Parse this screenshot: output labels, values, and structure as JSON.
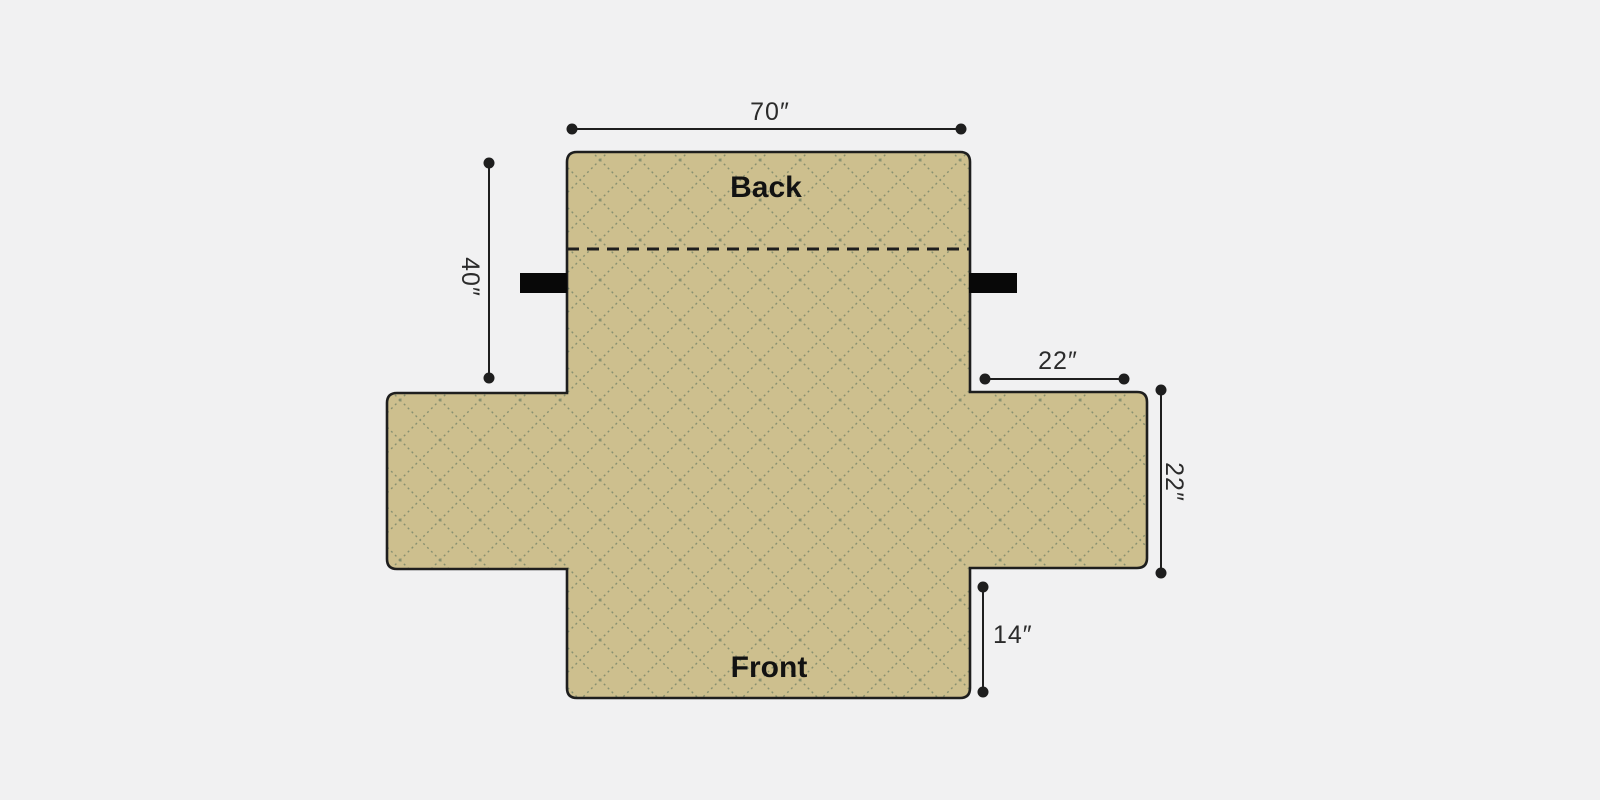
{
  "diagram": {
    "labels": {
      "back": "Back",
      "front": "Front"
    },
    "dimensions": {
      "total_width": "70″",
      "back_height": "40″",
      "arm_width": "22″",
      "arm_depth": "22″",
      "front_height": "14″"
    },
    "colors": {
      "background": "#f1f1f2",
      "fabric": "#cdbf8e",
      "quilt-line": "#879070",
      "outline": "#1e1e1e",
      "strap": "#080808",
      "dimension-line": "#1e1e1e",
      "dimension-text": "#2b2b2b",
      "label-text": "#121212"
    }
  }
}
